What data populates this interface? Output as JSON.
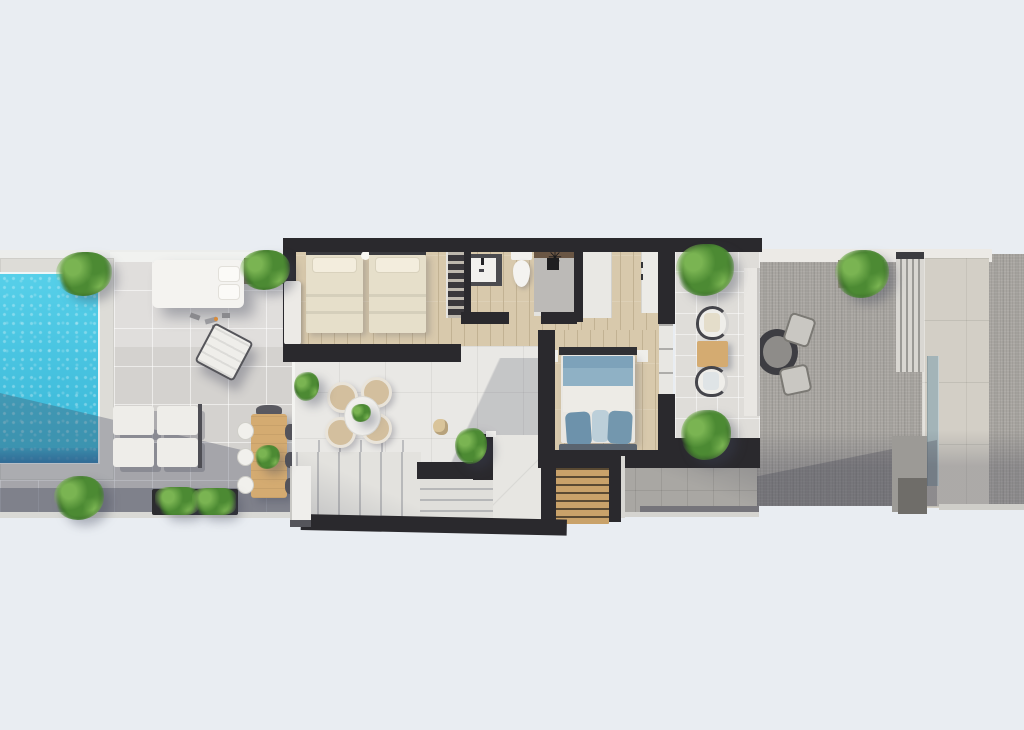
{
  "canvas": {
    "width": 1024,
    "height": 730
  },
  "scene_type": "3d-floorplan-top-view",
  "palette": {
    "bg": "#e9edf2",
    "wall": "#2a292d",
    "wallSoft": "#3a3a3e",
    "tile": "#d4d2cf",
    "whiteFloor": "#e9e8e5",
    "wood": "#d8c9ac",
    "woodLine": "#c2b293",
    "gravel": "#a9a6a1",
    "stone": "#d3cfc6",
    "pool": "#3fc9e6",
    "poolDeep": "#2b7cb0",
    "coping": "#dddcd7",
    "furnWood": "#d4ab71",
    "stairWood": "#c9a26a",
    "plant1": "#7ab452",
    "plant2": "#4c8a33",
    "plant3": "#2c5a1f",
    "linen": "#e6dfca",
    "pillow": "#f3eddd",
    "blanketBlue": "#8fb1c5",
    "pillowBlue": "#6d92ab",
    "bench": "#5a646f",
    "shadow": "rgba(66,72,92,0.32)",
    "white": "#f0efec"
  },
  "inventory": {
    "outdoor_left_terrace": [
      "swimming-pool",
      "pool-deck",
      "daybed",
      "planter",
      "accessories",
      "folded-lounge-chair",
      "sun-loungers-2x2",
      "wood-dining-table",
      "dining-chairs",
      "long-planter",
      "plants"
    ],
    "house": [
      "twin-bedroom",
      "open-wardrobe",
      "bathroom",
      "walk-in-closet",
      "hallway",
      "master-bedroom",
      "lounge-landing",
      "white-staircase",
      "wooden-staircase"
    ],
    "bathroom": [
      "vanity-sink",
      "toilet",
      "shower"
    ],
    "twin_bedroom": [
      "single-bed",
      "single-bed",
      "round-stool"
    ],
    "master_bedroom": [
      "double-bed",
      "blue-blanket",
      "pillows",
      "foot-bench",
      "nightstands",
      "sliding-glass-door"
    ],
    "lounge_landing": [
      "round-lounge-chairs-x4",
      "round-table-with-plant",
      "corner-plant",
      "cat"
    ],
    "balcony": [
      "armchair",
      "side-table",
      "armchair",
      "planter-top",
      "planter-bottom",
      "divider-wall"
    ],
    "outdoor_right_terrace": [
      "gravel-paving",
      "round-bistro-table",
      "chairs-x2",
      "planter-box",
      "louvered-screen",
      "stone-wall",
      "glass-strip"
    ]
  }
}
